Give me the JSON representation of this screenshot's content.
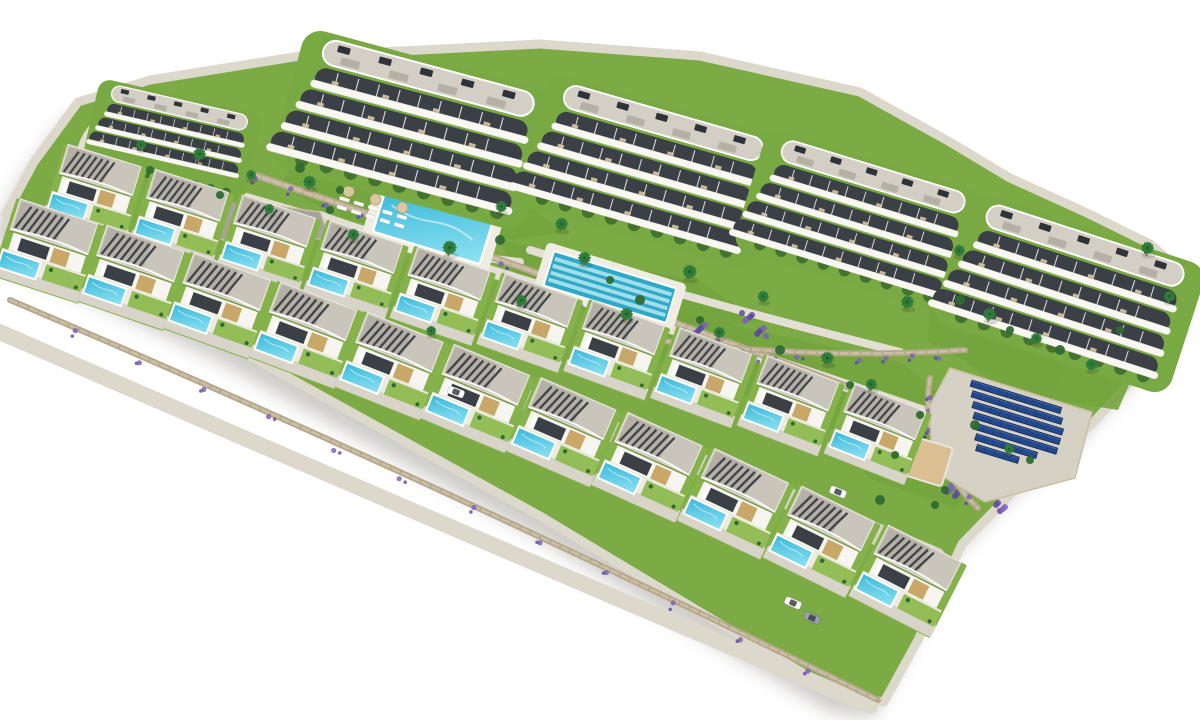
{
  "scene": {
    "canvas": {
      "w": 1200,
      "h": 720
    },
    "palette": {
      "bg": "#ffffff",
      "shadow": "#9d9890",
      "grass": "#7cab46",
      "lawnDark": "#74a43d",
      "lawnLight": "#86b453",
      "gardenPad": "#79a943",
      "villaPlot": "#86b24c",
      "villaLawn": "#92bd57",
      "driveway": "#d8d4c9",
      "terrace": "#edeadf",
      "path": "#e3dfd4",
      "road": "#d6d1c5",
      "frontWalk": "#ddd8cc",
      "plaza": "#a6a39c",
      "sand": "#d9bf92",
      "stone": "#b5a88c",
      "stoneLight": "#cabfa4",
      "lavender": "#7b63b8",
      "lavenderDark": "#5d48a0",
      "poolDeep": "#3ab7d8",
      "poolLight": "#8fe3f3",
      "lapWater": "#2fa9c8",
      "lapLane": "#b5e7f0",
      "poolDeck": "#efece2",
      "roofDeck": "#d3cfc5",
      "roofLight": "#c9c5ba",
      "roofMid": "#b4b0a5",
      "roofEdge": "#e9e6dd",
      "slat": "#42464b",
      "balcony": "#f8f7f2",
      "villaWall": "#f6f5f0",
      "glass": "#3a4046",
      "wood": "#c8a768",
      "hedge": "#41702f",
      "bush": "#2f6a33",
      "palm": "#2f7c3a",
      "trunk": "#8a6b43",
      "solar": "#24488c",
      "solarDark": "#12264e",
      "solarLight": "#4e79c4",
      "ac": "#2e3338",
      "carWhite": "#fbfbf9",
      "carGray": "#9aa0a6",
      "parasol": "#d9c7a0",
      "loungerWhite": "#fbfaf6",
      "loungerDark": "#42464c"
    },
    "site_outline": [
      [
        78,
        102
      ],
      [
        150,
        80
      ],
      [
        300,
        56
      ],
      [
        540,
        44
      ],
      [
        700,
        56
      ],
      [
        860,
        92
      ],
      [
        950,
        142
      ],
      [
        1010,
        178
      ],
      [
        1085,
        212
      ],
      [
        1150,
        244
      ],
      [
        1192,
        280
      ],
      [
        1188,
        316
      ],
      [
        1148,
        362
      ],
      [
        1092,
        424
      ],
      [
        1022,
        482
      ],
      [
        962,
        544
      ],
      [
        918,
        640
      ],
      [
        884,
        702
      ],
      [
        842,
        696
      ],
      [
        700,
        612
      ],
      [
        540,
        516
      ],
      [
        380,
        428
      ],
      [
        228,
        344
      ],
      [
        88,
        278
      ],
      [
        14,
        244
      ],
      [
        6,
        214
      ],
      [
        34,
        162
      ]
    ],
    "lawns": [
      {
        "points": [
          [
            295,
            162
          ],
          [
            520,
            198
          ],
          [
            562,
            232
          ],
          [
            462,
            248
          ],
          [
            330,
            214
          ],
          [
            282,
            184
          ]
        ]
      },
      {
        "points": [
          [
            500,
            240
          ],
          [
            700,
            282
          ],
          [
            762,
            322
          ],
          [
            640,
            332
          ],
          [
            520,
            286
          ]
        ]
      },
      {
        "points": [
          [
            930,
            252
          ],
          [
            1085,
            322
          ],
          [
            1050,
            402
          ],
          [
            928,
            342
          ]
        ]
      },
      {
        "points": [
          [
            620,
            300
          ],
          [
            900,
            362
          ],
          [
            1000,
            442
          ],
          [
            840,
            432
          ],
          [
            640,
            352
          ]
        ]
      },
      {
        "points": [
          [
            862,
            392
          ],
          [
            965,
            420
          ],
          [
            990,
            470
          ],
          [
            955,
            508
          ],
          [
            868,
            478
          ],
          [
            845,
            428
          ]
        ]
      },
      {
        "points": [
          [
            975,
            330
          ],
          [
            1140,
            360
          ],
          [
            1118,
            410
          ],
          [
            1005,
            392
          ],
          [
            958,
            356
          ]
        ]
      }
    ],
    "paths": [
      {
        "d": "M 115,162 Q 560,285 1005,440",
        "w": 12,
        "color": "path"
      },
      {
        "d": "M 15,235 Q 470,365 935,558",
        "w": 22,
        "color": "road"
      },
      {
        "d": "M -5,330 Q 420,515 870,706",
        "w": 16,
        "color": "frontWalk"
      },
      {
        "d": "M 95,196 Q 58,148 118,106",
        "w": 10,
        "color": "path"
      },
      {
        "d": "M 320,215 Q 420,252 520,262",
        "w": 8,
        "color": "path"
      },
      {
        "d": "M 530,250 Q 700,302 900,352",
        "w": 8,
        "color": "path"
      }
    ],
    "walls": [
      {
        "p0": [
          180,
          150
        ],
        "c": [
          600,
          290
        ],
        "p1": [
          1000,
          445
        ],
        "w": 7,
        "lavender": 22
      },
      {
        "p0": [
          600,
          332
        ],
        "c": [
          790,
          362
        ],
        "p1": [
          965,
          350
        ],
        "w": 6,
        "lavender": 12
      },
      {
        "p0": [
          930,
          378
        ],
        "c": [
          918,
          450
        ],
        "p1": [
          978,
          508
        ],
        "w": 6,
        "lavender": 8
      },
      {
        "p0": [
          10,
          300
        ],
        "c": [
          430,
          478
        ],
        "p1": [
          878,
          700
        ],
        "w": 6,
        "lavender": 12
      },
      {
        "p0": [
          88,
          200
        ],
        "c": [
          70,
          160
        ],
        "p1": [
          110,
          118
        ],
        "w": 5,
        "lavender": 4
      }
    ],
    "lavender_patches": [
      [
        748,
        318
      ],
      [
        762,
        332
      ],
      [
        906,
        262
      ],
      [
        928,
        274
      ],
      [
        700,
        330
      ],
      [
        952,
        492
      ],
      [
        1000,
        508
      ],
      [
        585,
        300
      ]
    ],
    "plaza": {
      "points": [
        [
          178,
          192
        ],
        [
          320,
          212
        ],
        [
          330,
          238
        ],
        [
          232,
          244
        ],
        [
          172,
          216
        ]
      ],
      "sand_spots": [
        [
          212,
          208,
          11
        ],
        [
          258,
          226,
          8
        ]
      ],
      "play_dots": [
        [
          238,
          218,
          "#c0504d"
        ],
        [
          246,
          224,
          "#4f81bd"
        ],
        [
          230,
          228,
          "#d9a23b"
        ]
      ]
    },
    "pools": {
      "leisure": {
        "x": 433,
        "y": 226,
        "rot": 17,
        "w": 112,
        "h": 46,
        "deck_w": 132,
        "deck_h": 64
      },
      "lap": {
        "x": 610,
        "y": 287,
        "rot": 17,
        "w": 128,
        "h": 36,
        "deck_w": 146,
        "deck_h": 50,
        "lanes": 4
      }
    },
    "lounger_groups": [
      {
        "x": 340,
        "y": 196,
        "rot": 17,
        "rows": 2,
        "cols": 5,
        "color": "loungerWhite",
        "parasols": 3
      },
      {
        "x": 468,
        "y": 192,
        "rot": 17,
        "rows": 1,
        "cols": 4,
        "color": "loungerWhite",
        "parasols": 2
      },
      {
        "x": 888,
        "y": 424,
        "rot": 18,
        "rows": 1,
        "cols": 6,
        "color": "loungerDark",
        "parasols": 0
      },
      {
        "x": 1058,
        "y": 338,
        "rot": 18,
        "rows": 1,
        "cols": 4,
        "color": "loungerWhite",
        "parasols": 2
      }
    ],
    "apartments": [
      {
        "x": 172,
        "y": 140,
        "rot": 13,
        "s": 0.62,
        "bands": 3
      },
      {
        "x": 415,
        "y": 128,
        "rot": 15,
        "s": 0.97,
        "bands": 4
      },
      {
        "x": 650,
        "y": 170,
        "rot": 16,
        "s": 0.92,
        "bands": 4
      },
      {
        "x": 860,
        "y": 220,
        "rot": 17,
        "s": 0.85,
        "bands": 4
      },
      {
        "x": 1070,
        "y": 292,
        "rot": 18,
        "s": 0.92,
        "bands": 4
      }
    ],
    "villa_rows": [
      {
        "x0": 95,
        "y0": 192,
        "dx": 87,
        "dy": 25,
        "curve": 0.2,
        "count": 10,
        "rot0": 17,
        "drot": 0.5,
        "s": 0.94
      },
      {
        "x0": 48,
        "y0": 250,
        "dx": 86,
        "dy": 26,
        "curve": 0.7,
        "count": 11,
        "rot0": 18,
        "drot": 0.9,
        "s": 1.0
      }
    ],
    "solar": {
      "pad": [
        [
          950,
          368
        ],
        [
          1092,
          412
        ],
        [
          1075,
          478
        ],
        [
          985,
          502
        ],
        [
          932,
          470
        ],
        [
          930,
          405
        ]
      ],
      "x": 972,
      "y": 380,
      "rot": 17,
      "rows": [
        94,
        94,
        94,
        90,
        86,
        64,
        44
      ],
      "row_h": 6.5,
      "gap": 3.5
    },
    "sand_court": {
      "x": 910,
      "y": 456,
      "rot": 17,
      "w": 78,
      "h": 40
    },
    "cars": [
      {
        "x": 456,
        "y": 392,
        "rot": 20,
        "color": "carWhite"
      },
      {
        "x": 838,
        "y": 492,
        "rot": 22,
        "color": "carWhite"
      },
      {
        "x": 812,
        "y": 618,
        "rot": 24,
        "color": "carGray"
      },
      {
        "x": 793,
        "y": 603,
        "rot": 24,
        "color": "carWhite"
      }
    ],
    "palms": [
      [
        198,
        158,
        1
      ],
      [
        250,
        178,
        0.8
      ],
      [
        308,
        186,
        1
      ],
      [
        352,
        238,
        0.9
      ],
      [
        448,
        252,
        1.1
      ],
      [
        560,
        228,
        1
      ],
      [
        520,
        304,
        0.9
      ],
      [
        625,
        318,
        1
      ],
      [
        688,
        276,
        1.1
      ],
      [
        762,
        300,
        0.9
      ],
      [
        826,
        362,
        1
      ],
      [
        906,
        306,
        1
      ],
      [
        958,
        254,
        0.9
      ],
      [
        988,
        318,
        1
      ],
      [
        1035,
        342,
        0.9
      ],
      [
        1146,
        252,
        1
      ],
      [
        1168,
        300,
        0.9
      ],
      [
        430,
        334,
        0.8
      ],
      [
        268,
        212,
        0.8
      ],
      [
        140,
        148,
        0.8
      ],
      [
        583,
        262,
        1
      ],
      [
        718,
        336,
        0.9
      ],
      [
        870,
        388,
        0.9
      ],
      [
        1090,
        368,
        0.9
      ],
      [
        1008,
        452,
        0.8
      ],
      [
        500,
        210,
        0.9
      ]
    ],
    "bushes": [
      [
        300,
        168,
        5
      ],
      [
        340,
        190,
        4
      ],
      [
        500,
        240,
        5
      ],
      [
        640,
        300,
        5
      ],
      [
        700,
        320,
        4
      ],
      [
        780,
        350,
        5
      ],
      [
        850,
        385,
        4
      ],
      [
        920,
        415,
        4
      ],
      [
        330,
        210,
        4
      ],
      [
        610,
        280,
        4
      ],
      [
        960,
        300,
        5
      ],
      [
        1010,
        330,
        4
      ],
      [
        1060,
        350,
        5
      ],
      [
        1120,
        330,
        4
      ],
      [
        150,
        170,
        4
      ],
      [
        220,
        195,
        4
      ],
      [
        975,
        425,
        5
      ],
      [
        1030,
        460,
        4
      ],
      [
        895,
        455,
        4
      ],
      [
        945,
        490,
        4
      ],
      [
        880,
        500,
        5
      ],
      [
        935,
        505,
        4
      ]
    ]
  }
}
